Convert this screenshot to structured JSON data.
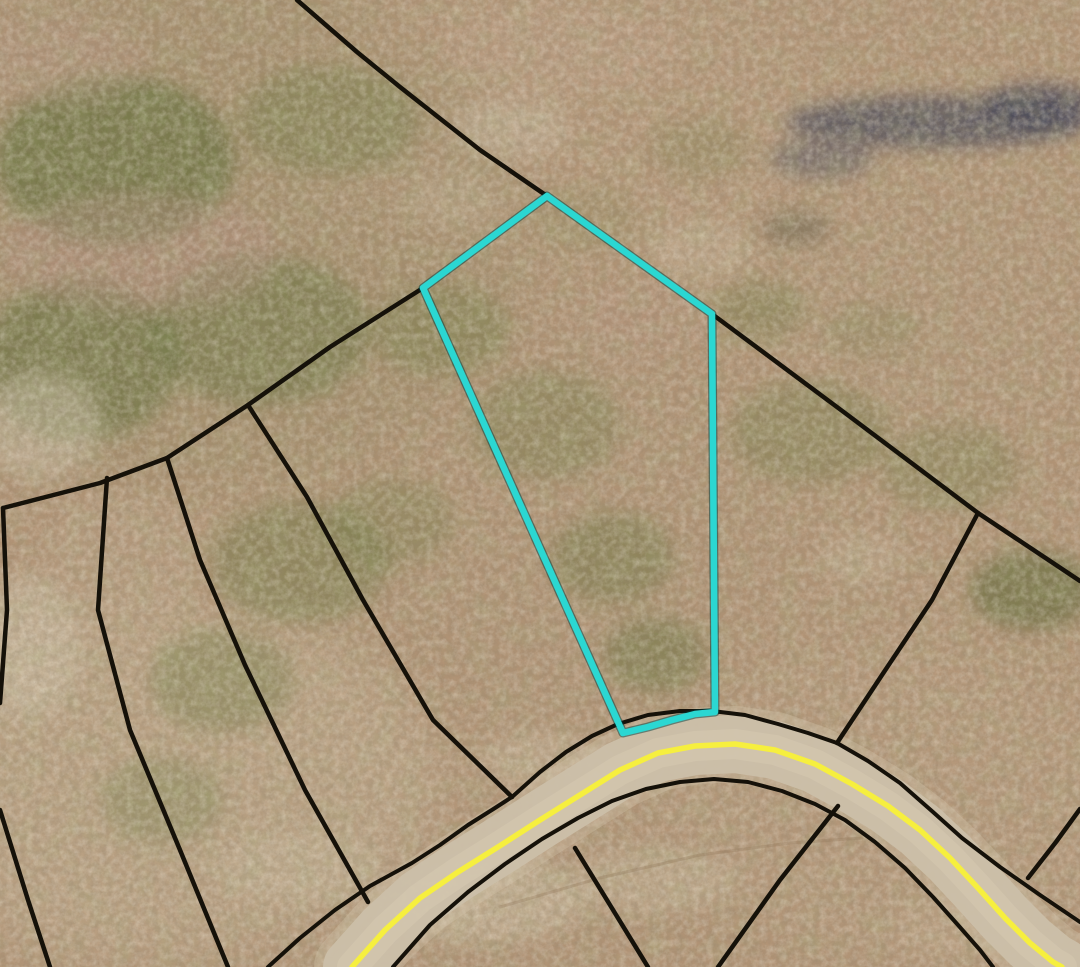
{
  "canvas": {
    "width": 1080,
    "height": 967
  },
  "colors": {
    "parcel_highlight": "#2bd7d2",
    "boundary_line": "#151109",
    "road_centerline_yellow": "#f6ef3e",
    "road_surface": "#cbbfa9",
    "road_surface_halo": "#d3c6ad",
    "road_surface_inner": "#dacdb3",
    "terrain_base": "#b29476",
    "dirt_track": "#8f7557"
  },
  "terrain": {
    "base": "#b29476",
    "patches": [
      [
        200,
        230,
        330,
        260,
        "#7c7d50",
        0.2,
        "lg"
      ],
      [
        560,
        120,
        270,
        150,
        "#bd9f82",
        0.22,
        "lg"
      ],
      [
        150,
        780,
        290,
        180,
        "#cfbfa2",
        0.3,
        "lg"
      ],
      [
        900,
        800,
        230,
        150,
        "#c2a98b",
        0.2,
        "lg"
      ],
      [
        540,
        500,
        260,
        230,
        "#a98f6f",
        0.15,
        "lg"
      ],
      [
        940,
        300,
        200,
        160,
        "#b59a7c",
        0.18,
        "lg"
      ],
      [
        115,
        160,
        120,
        85,
        "#5f6e38",
        0.65,
        "md"
      ],
      [
        260,
        330,
        110,
        75,
        "#687540",
        0.55,
        "md"
      ],
      [
        80,
        360,
        100,
        80,
        "#62703a",
        0.6,
        "md"
      ],
      [
        330,
        120,
        90,
        55,
        "#6d7a42",
        0.45,
        "md"
      ],
      [
        440,
        330,
        70,
        45,
        "#6f7c43",
        0.42,
        "md"
      ],
      [
        545,
        425,
        75,
        55,
        "#707c44",
        0.4,
        "md"
      ],
      [
        612,
        558,
        62,
        46,
        "#6a7640",
        0.45,
        "md"
      ],
      [
        655,
        655,
        52,
        38,
        "#66723e",
        0.5,
        "md"
      ],
      [
        760,
        310,
        46,
        30,
        "#6e7a42",
        0.4,
        "md"
      ],
      [
        810,
        432,
        80,
        52,
        "#6f7b44",
        0.4,
        "md"
      ],
      [
        950,
        468,
        70,
        44,
        "#727e46",
        0.36,
        "md"
      ],
      [
        1032,
        590,
        62,
        40,
        "#5c6836",
        0.6,
        "md"
      ],
      [
        300,
        562,
        90,
        62,
        "#6b7740",
        0.45,
        "md"
      ],
      [
        222,
        680,
        72,
        52,
        "#6f7b44",
        0.42,
        "md"
      ],
      [
        392,
        522,
        62,
        44,
        "#6f7b43",
        0.35,
        "md"
      ],
      [
        162,
        800,
        62,
        44,
        "#72804a",
        0.35,
        "md"
      ],
      [
        700,
        148,
        52,
        30,
        "#7a7f4c",
        0.3,
        "md"
      ],
      [
        872,
        330,
        48,
        28,
        "#7c8350",
        0.28,
        "md"
      ],
      [
        585,
        220,
        55,
        35,
        "#8a8a58",
        0.3,
        "md"
      ],
      [
        935,
        122,
        150,
        26,
        "#42465a",
        0.7,
        "md"
      ],
      [
        1042,
        106,
        58,
        22,
        "#3a3e54",
        0.72,
        "md"
      ],
      [
        822,
        158,
        52,
        20,
        "#4a4e60",
        0.5,
        "md"
      ],
      [
        796,
        228,
        36,
        17,
        "#55553f",
        0.42,
        "md"
      ],
      [
        140,
        252,
        140,
        60,
        "#b98f85",
        0.38,
        "md"
      ],
      [
        60,
        60,
        85,
        45,
        "#c09a8a",
        0.32,
        "md"
      ],
      [
        640,
        320,
        68,
        38,
        "#bb9684",
        0.26,
        "md"
      ],
      [
        560,
        50,
        120,
        45,
        "#c4a48c",
        0.3,
        "md"
      ],
      [
        40,
        425,
        62,
        52,
        "#cfc3ab",
        0.5,
        "md"
      ],
      [
        28,
        645,
        52,
        72,
        "#d3c7ae",
        0.48,
        "md"
      ],
      [
        482,
        900,
        105,
        42,
        "#d2c5a9",
        0.5,
        "md"
      ],
      [
        652,
        880,
        85,
        33,
        "#cdbfa3",
        0.42,
        "md"
      ],
      [
        300,
        868,
        82,
        36,
        "#c9ba9d",
        0.42,
        "md"
      ],
      [
        702,
        250,
        52,
        30,
        "#d0c2a6",
        0.32,
        "md"
      ],
      [
        452,
        200,
        46,
        26,
        "#cdbfa2",
        0.28,
        "md"
      ],
      [
        862,
        558,
        42,
        26,
        "#d0c3a7",
        0.3,
        "md"
      ],
      [
        122,
        556,
        80,
        62,
        "#bfa98c",
        0.32,
        "md"
      ],
      [
        542,
        760,
        65,
        28,
        "#d5c8ac",
        0.36,
        "md"
      ],
      [
        962,
        928,
        72,
        33,
        "#c6ad8f",
        0.38,
        "md"
      ],
      [
        510,
        128,
        60,
        30,
        "#d6cbb4",
        0.35,
        "md"
      ]
    ]
  },
  "map": {
    "highlighted_parcel": {
      "points": [
        [
          547,
          196
        ],
        [
          423,
          288
        ],
        [
          623,
          733
        ],
        [
          648,
          727
        ],
        [
          672,
          720
        ],
        [
          695,
          714
        ],
        [
          715,
          712
        ],
        [
          712,
          314
        ]
      ]
    },
    "boundaries": [
      {
        "id": "north-diagonal",
        "points": [
          [
            297,
            0
          ],
          [
            357,
            52
          ],
          [
            400,
            87
          ],
          [
            480,
            150
          ],
          [
            547,
            196
          ]
        ]
      },
      {
        "id": "parcel-top-right",
        "points": [
          [
            547,
            196
          ],
          [
            630,
            255
          ],
          [
            712,
            314
          ]
        ]
      },
      {
        "id": "east-diagonal",
        "points": [
          [
            712,
            314
          ],
          [
            845,
            413
          ],
          [
            978,
            513
          ],
          [
            1080,
            581
          ]
        ]
      },
      {
        "id": "east-branch-to-road",
        "points": [
          [
            978,
            513
          ],
          [
            932,
            600
          ],
          [
            882,
            675
          ],
          [
            837,
            743
          ]
        ]
      },
      {
        "id": "east-stub",
        "points": [
          [
            1080,
            809
          ],
          [
            1056,
            842
          ],
          [
            1028,
            878
          ]
        ]
      },
      {
        "id": "west-long-line",
        "points": [
          [
            423,
            288
          ],
          [
            330,
            347
          ],
          [
            248,
            405
          ],
          [
            167,
            458
          ],
          [
            100,
            483
          ],
          [
            3,
            508
          ]
        ]
      },
      {
        "id": "west-edge-drop",
        "points": [
          [
            3,
            508
          ],
          [
            7,
            610
          ],
          [
            0,
            703
          ]
        ]
      },
      {
        "id": "corner-stub",
        "points": [
          [
            0,
            810
          ],
          [
            28,
            900
          ],
          [
            50,
            967
          ]
        ]
      },
      {
        "id": "fan-line-1",
        "points": [
          [
            107,
            478
          ],
          [
            98,
            610
          ],
          [
            130,
            730
          ],
          [
            180,
            850
          ],
          [
            228,
            967
          ]
        ]
      },
      {
        "id": "fan-line-2",
        "points": [
          [
            167,
            458
          ],
          [
            200,
            560
          ],
          [
            245,
            665
          ],
          [
            305,
            790
          ],
          [
            368,
            902
          ]
        ]
      },
      {
        "id": "fan-line-3",
        "points": [
          [
            248,
            405
          ],
          [
            307,
            497
          ],
          [
            363,
            600
          ],
          [
            433,
            720
          ],
          [
            512,
            797
          ]
        ]
      },
      {
        "id": "south-stub-1",
        "points": [
          [
            575,
            848
          ],
          [
            610,
            905
          ],
          [
            648,
            967
          ]
        ]
      },
      {
        "id": "south-stub-2",
        "points": [
          [
            838,
            806
          ],
          [
            780,
            880
          ],
          [
            718,
            967
          ]
        ]
      }
    ],
    "road": {
      "centerline": [
        [
          352,
          967
        ],
        [
          385,
          930
        ],
        [
          420,
          898
        ],
        [
          458,
          872
        ],
        [
          498,
          847
        ],
        [
          540,
          820
        ],
        [
          580,
          795
        ],
        [
          620,
          770
        ],
        [
          658,
          753
        ],
        [
          695,
          746
        ],
        [
          735,
          744
        ],
        [
          775,
          750
        ],
        [
          815,
          764
        ],
        [
          852,
          784
        ],
        [
          888,
          806
        ],
        [
          920,
          830
        ],
        [
          950,
          858
        ],
        [
          978,
          888
        ],
        [
          1005,
          918
        ],
        [
          1030,
          943
        ],
        [
          1053,
          962
        ],
        [
          1062,
          967
        ]
      ],
      "upper_edge": [
        [
          268,
          967
        ],
        [
          300,
          938
        ],
        [
          335,
          910
        ],
        [
          370,
          886
        ],
        [
          412,
          863
        ],
        [
          440,
          845
        ],
        [
          468,
          825
        ],
        [
          495,
          808
        ],
        [
          512,
          797
        ],
        [
          540,
          772
        ],
        [
          566,
          752
        ],
        [
          592,
          736
        ],
        [
          618,
          724
        ],
        [
          648,
          715
        ],
        [
          680,
          711
        ],
        [
          712,
          711
        ],
        [
          745,
          715
        ],
        [
          778,
          724
        ],
        [
          808,
          733
        ],
        [
          837,
          743
        ],
        [
          868,
          761
        ],
        [
          900,
          783
        ],
        [
          933,
          812
        ],
        [
          962,
          838
        ],
        [
          1000,
          867
        ],
        [
          1040,
          895
        ],
        [
          1080,
          922
        ]
      ],
      "lower_edge": [
        [
          393,
          967
        ],
        [
          430,
          925
        ],
        [
          468,
          892
        ],
        [
          505,
          864
        ],
        [
          542,
          839
        ],
        [
          578,
          818
        ],
        [
          612,
          801
        ],
        [
          646,
          789
        ],
        [
          680,
          782
        ],
        [
          714,
          779
        ],
        [
          748,
          782
        ],
        [
          782,
          791
        ],
        [
          815,
          804
        ],
        [
          845,
          820
        ],
        [
          875,
          842
        ],
        [
          905,
          868
        ],
        [
          933,
          897
        ],
        [
          958,
          925
        ],
        [
          980,
          950
        ],
        [
          993,
          967
        ]
      ]
    },
    "track": {
      "points": [
        [
          500,
          907
        ],
        [
          600,
          878
        ],
        [
          700,
          855
        ],
        [
          790,
          843
        ],
        [
          862,
          838
        ]
      ]
    }
  }
}
